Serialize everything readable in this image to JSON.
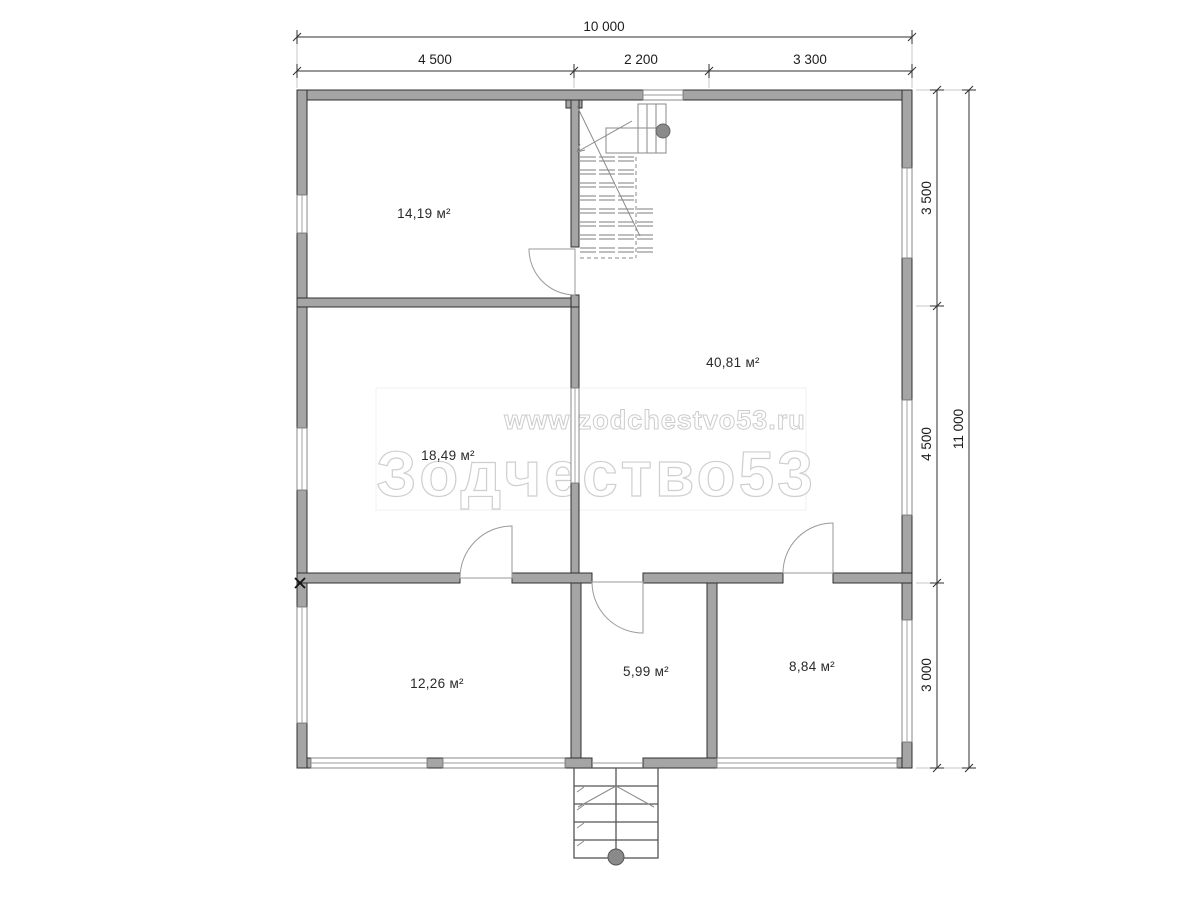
{
  "watermark": {
    "url": "www.zodchestvo53.ru",
    "brand": "Зодчество53"
  },
  "rooms": [
    {
      "area": "14,19 м²"
    },
    {
      "area": "40,81 м²"
    },
    {
      "area": "18,49 м²"
    },
    {
      "area": "12,26 м²"
    },
    {
      "area": "5,99 м²"
    },
    {
      "area": "8,84 м²"
    }
  ],
  "dimensions": {
    "top": {
      "total": "10 000",
      "segments": [
        "4 500",
        "2 200",
        "3 300"
      ]
    },
    "right": {
      "total": "11 000",
      "segments": [
        "3 500",
        "4 500",
        "3 000"
      ]
    }
  }
}
